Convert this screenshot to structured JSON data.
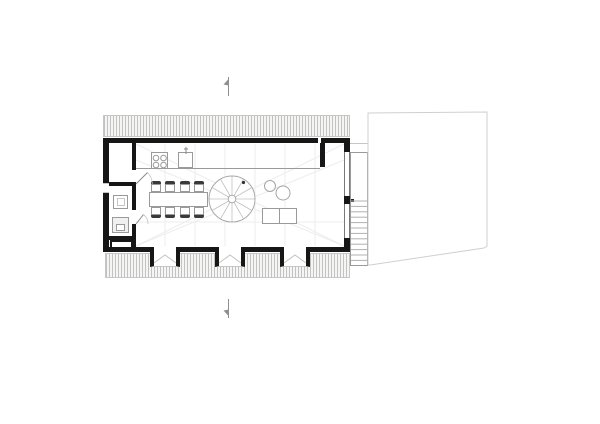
{
  "meta": {
    "drawing_type": "architectural floor plan",
    "view": "ground floor plan, black-line drawing on white background",
    "visible_text": "none"
  },
  "colors": {
    "canvas_bg": "#ffffff",
    "wall": "#161616",
    "line_dark": "#787878",
    "line_mid": "#9a9a9a",
    "line_light": "#c6c6c6",
    "faint": "#ececec",
    "hatch_line": "#c2c2c2",
    "hatch_bg": "#f5f5f4",
    "marker": "#8f8f8f",
    "chair_back": "#3a3a3a",
    "building_outline": "#cfcfcf"
  },
  "inventory": {
    "masonry_hatch_bands": 2,
    "window_bays_bottom": 3,
    "dining_chairs": 8,
    "hob_burners": 4,
    "round_stools": 2,
    "section_markers": 2,
    "features": [
      "open living room",
      "kitchen counter with hob and sink",
      "dining table with eight chairs",
      "spiral staircase",
      "two round stools and low table",
      "storage room top-left",
      "bathroom with basin and wc",
      "exterior straight stair on right",
      "adjacent building outline right",
      "section cut markers top and bottom"
    ]
  },
  "plan": {
    "chairs": {
      "columns": [
        151,
        165,
        180,
        194
      ],
      "top_row_y": 181,
      "bottom_row_y": 207,
      "chair_w": 10,
      "back_h": 3,
      "seat_h": 8
    },
    "bays": {
      "x_positions": [
        150,
        215,
        280
      ],
      "y": 247,
      "width": 30,
      "height": 20
    },
    "treads": {
      "count": 12,
      "x1": 351,
      "x2": 367,
      "y_start": 201,
      "step": 5.4
    },
    "spiral": {
      "cx": 232,
      "cy": 199,
      "r": 23,
      "hub_r": 3.8,
      "spokes": 12,
      "dot": {
        "x": 243.5,
        "y": 182.5,
        "r": 1.6
      }
    },
    "hob": {
      "centers": [
        [
          156,
          158
        ],
        [
          163.5,
          158
        ],
        [
          156,
          165
        ],
        [
          163.5,
          165
        ]
      ],
      "burner_r": 2.8
    }
  }
}
